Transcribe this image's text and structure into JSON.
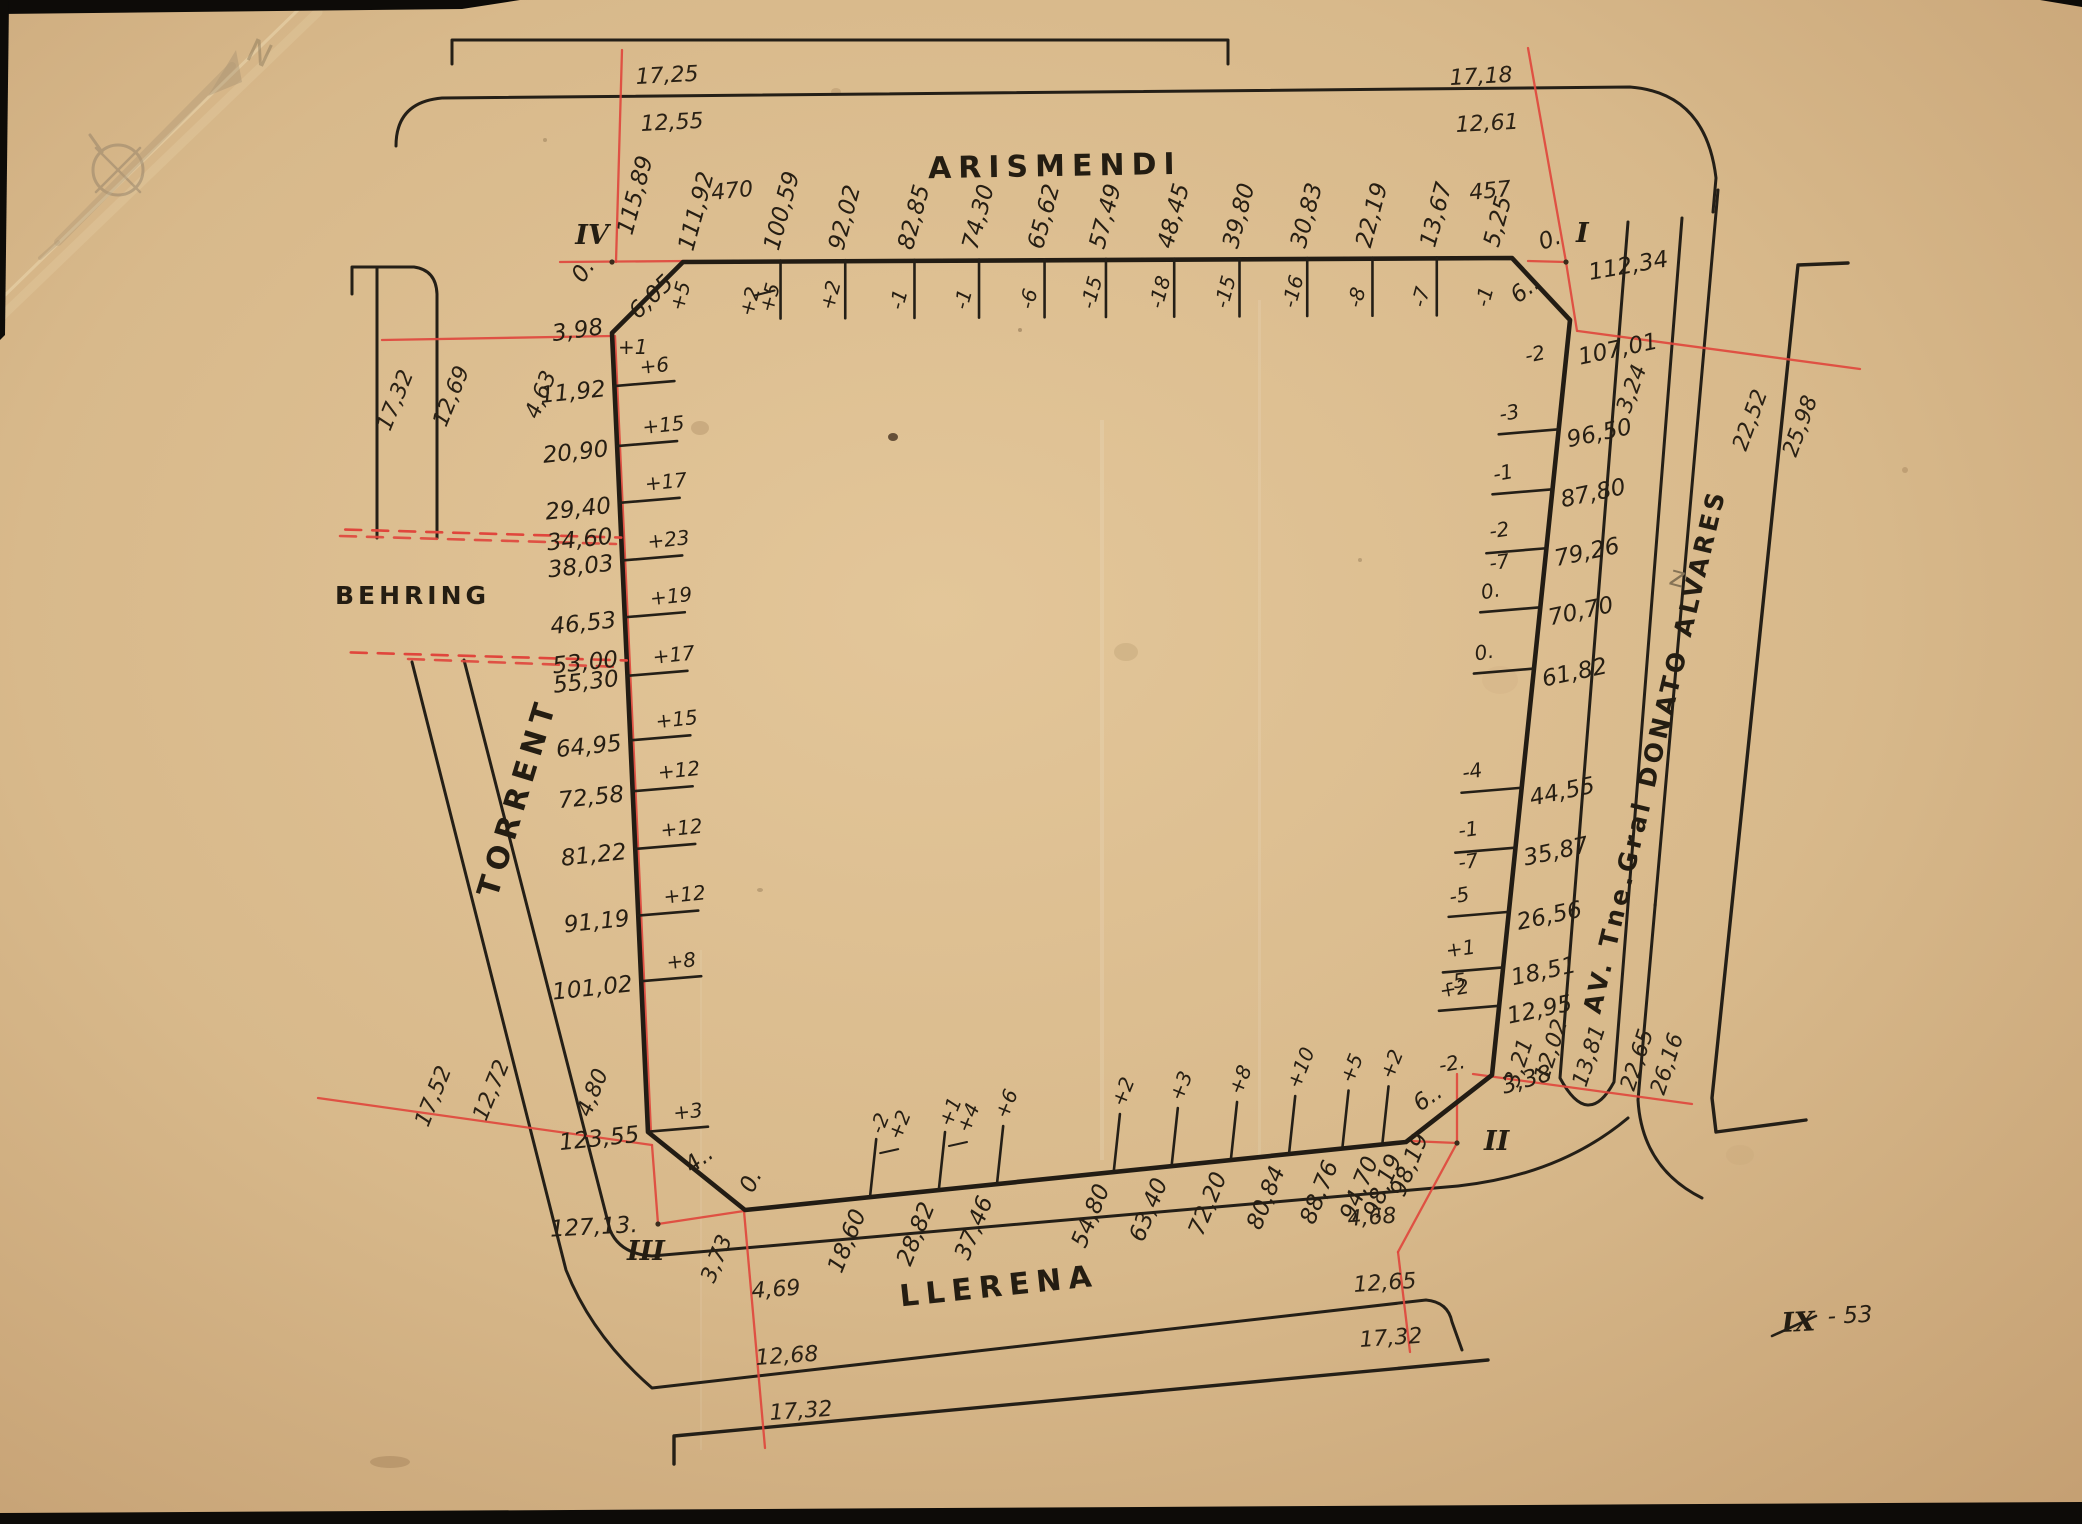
{
  "sheet": {
    "plate": {
      "roman": "IX",
      "number": "- 53"
    },
    "compass_letter": "N",
    "pencil_mark": "z"
  },
  "streets": {
    "top": "ARISMENDI",
    "bottom": "LLERENA",
    "left": "TORRENT",
    "west": "BEHRING",
    "right": "AV. Tne.Gral DONATO ALVARES"
  },
  "block": {
    "corners": {
      "IV": {
        "roman": "IV",
        "zero": "0.",
        "corner_station": "115,89",
        "chamfer_len": "6,05",
        "first_station": "3,98",
        "first_offset": "+1"
      },
      "I": {
        "roman": "I",
        "zero": "0.",
        "corner_station": "112,34",
        "chamfer_len": "6.."
      },
      "II": {
        "roman": "II",
        "chamfer_len": "6..",
        "end_station": "98,19"
      },
      "III": {
        "roman": "III",
        "zero": "0.",
        "corner_station": "127,13.",
        "chamfer_len": "4.."
      }
    },
    "top_edge": {
      "stations": [
        {
          "s": "111,92",
          "o": "+5",
          "v": 111.92,
          "tick": false
        },
        {
          "s": "100,59",
          "o": "+5/+2",
          "v": 100.59
        },
        {
          "s": "92,02",
          "o": "+2",
          "v": 92.02
        },
        {
          "s": "82,85",
          "o": "-1",
          "v": 82.85
        },
        {
          "s": "74,30",
          "o": "-1",
          "v": 74.3
        },
        {
          "s": "65,62",
          "o": "-6",
          "v": 65.62
        },
        {
          "s": "57,49",
          "o": "-15",
          "v": 57.49
        },
        {
          "s": "48,45",
          "o": "-18",
          "v": 48.45
        },
        {
          "s": "39,80",
          "o": "-15",
          "v": 39.8
        },
        {
          "s": "30,83",
          "o": "-16",
          "v": 30.83
        },
        {
          "s": "22,19",
          "o": "-8",
          "v": 22.19
        },
        {
          "s": "13,67",
          "o": "-7",
          "v": 13.67
        },
        {
          "s": "5,25",
          "o": "-1",
          "v": 5.25,
          "tick": false
        }
      ]
    },
    "left_edge": {
      "stations": [
        {
          "s": "11,92",
          "o": "+6",
          "v": 11.92
        },
        {
          "s": "20,90",
          "o": "+15",
          "v": 20.9
        },
        {
          "s": "29,40",
          "o": "+17",
          "v": 29.4
        },
        {
          "s": "34,60",
          "v": 34.6,
          "dashed": true
        },
        {
          "s": "38,03",
          "o": "+23",
          "v": 38.03
        },
        {
          "s": "46,53",
          "o": "+19",
          "v": 46.53
        },
        {
          "s": "53,00",
          "v": 53.0,
          "dashed": true
        },
        {
          "s": "55,30",
          "o": "+17",
          "v": 55.3
        },
        {
          "s": "64,95",
          "o": "+15",
          "v": 64.95
        },
        {
          "s": "72,58",
          "o": "+12",
          "v": 72.58
        },
        {
          "s": "81,22",
          "o": "+12",
          "v": 81.22
        },
        {
          "s": "91,19",
          "o": "+12",
          "v": 91.19
        },
        {
          "s": "101,02",
          "o": "+8",
          "v": 101.02
        },
        {
          "s": "123,55",
          "o": "+3",
          "v": 123.55
        }
      ]
    },
    "right_edge": {
      "stations": [
        {
          "s": "107,01",
          "o": "-2",
          "v": 107.01,
          "tick": false
        },
        {
          "s": "96,50",
          "o": "-3",
          "v": 96.5
        },
        {
          "s": "87,80",
          "o": "-1",
          "v": 87.8
        },
        {
          "s": "79,26",
          "o": "-2/-7",
          "v": 79.26
        },
        {
          "s": "70,70",
          "o": "0.",
          "v": 70.7
        },
        {
          "s": "61,82",
          "o": "0.",
          "v": 61.82
        },
        {
          "s": "44,55",
          "o": "-4",
          "v": 44.55
        },
        {
          "s": "35,87",
          "o": "-1/-7",
          "v": 35.87
        },
        {
          "s": "26,56",
          "o": "-5",
          "v": 26.56
        },
        {
          "s": "18,51",
          "o": "+1/-5",
          "v": 18.51
        },
        {
          "s": "12,95",
          "o": "+2",
          "v": 12.95
        },
        {
          "s": "3,38",
          "o": "-2.",
          "v": 3.38,
          "tick": false
        }
      ]
    },
    "bottom_edge": {
      "start_zero": "0.",
      "stations": [
        {
          "s": "18,60",
          "o": "-2/+2",
          "v": 18.6
        },
        {
          "s": "28,82",
          "o": "+1/+4",
          "v": 28.82
        },
        {
          "s": "37,46",
          "o": "+6",
          "v": 37.46
        },
        {
          "s": "54,80",
          "o": "+2",
          "v": 54.8
        },
        {
          "s": "63,40",
          "o": "+3",
          "v": 63.4
        },
        {
          "s": "72,20",
          "o": "+8",
          "v": 72.2
        },
        {
          "s": "80,84",
          "o": "+10",
          "v": 80.84
        },
        {
          "s": "88,76",
          "o": "+5",
          "v": 88.76
        },
        {
          "s": "94,70",
          "o": "+2",
          "v": 94.7
        },
        {
          "s": "98,19",
          "v": 98.19,
          "tick": false
        }
      ]
    }
  },
  "measures": {
    "arismendi_left": [
      "17,25",
      "12,55",
      "470"
    ],
    "arismendi_right": [
      "17,18",
      "12,61",
      "457"
    ],
    "behring_row": [
      "17,32",
      "12,69",
      "4,63"
    ],
    "torrent_lower": [
      "17,52",
      "12,72",
      "4,80"
    ],
    "llerena_left": [
      "3,73",
      "4,69",
      "12,68",
      "17,32"
    ],
    "llerena_right": [
      "4,68",
      "12,65",
      "17,32"
    ],
    "alvares_top": [
      "3,24",
      "22,52",
      "25,98"
    ],
    "alvares_bottom": [
      "3,21",
      "12,02",
      "13,81",
      "22,65",
      "26,16"
    ]
  }
}
